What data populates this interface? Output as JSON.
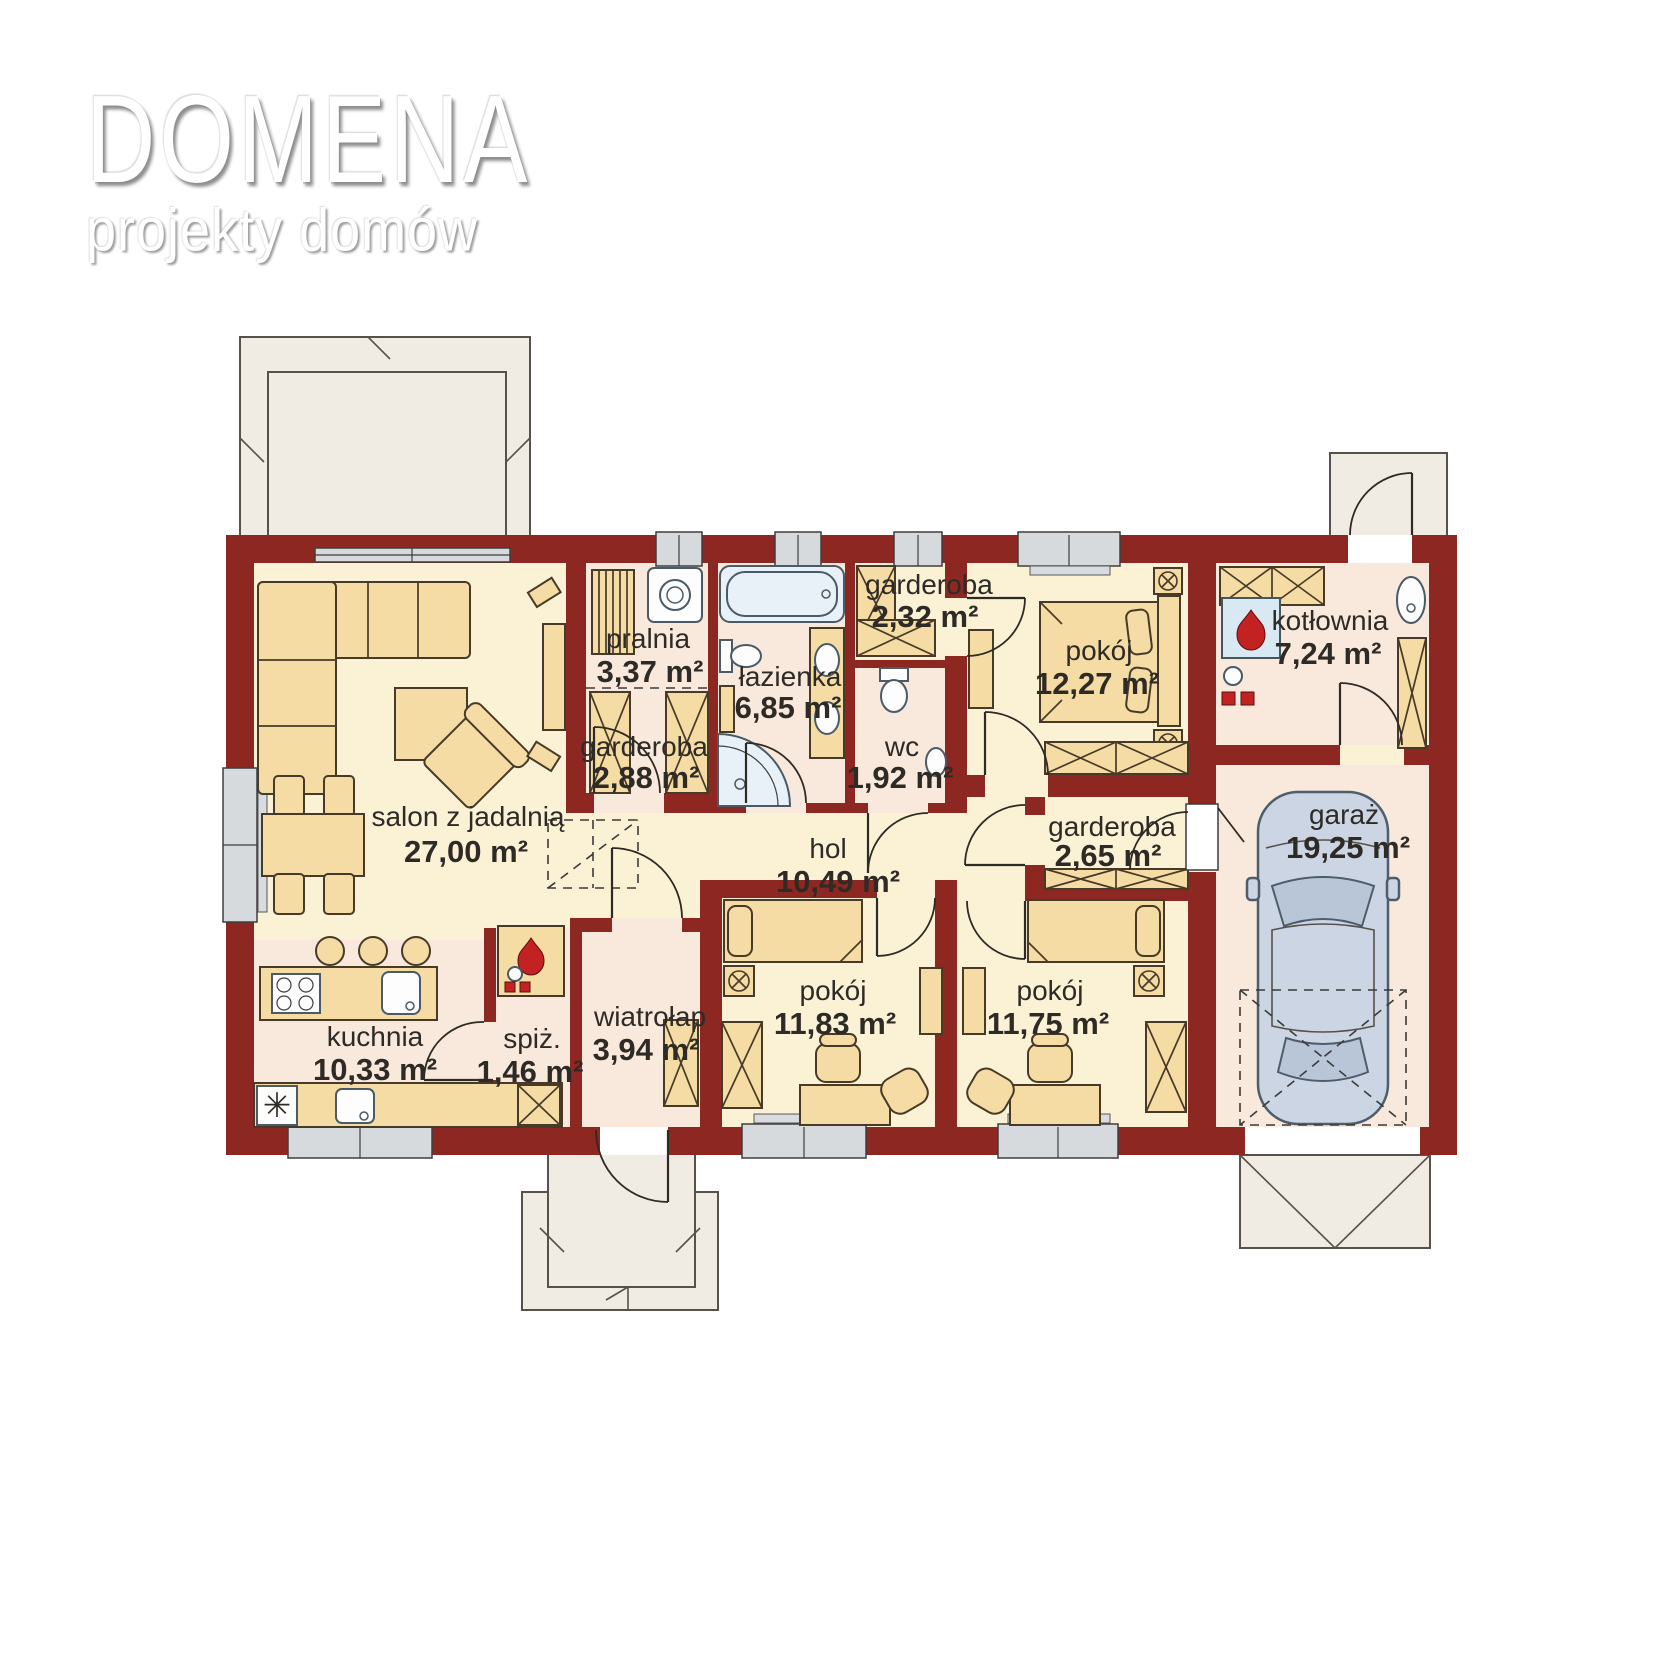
{
  "logo": {
    "title": "DOMENA",
    "subtitle": "projekty domów"
  },
  "plan": {
    "rooms": [
      {
        "id": "salon",
        "name": "salon z jadalnią",
        "area": "27,00 m²"
      },
      {
        "id": "pralnia",
        "name": "pralnia",
        "area": "3,37 m²"
      },
      {
        "id": "garderoba1",
        "name": "garderoba",
        "area": "2,88 m²"
      },
      {
        "id": "lazienka",
        "name": "łazienka",
        "area": "6,85 m²"
      },
      {
        "id": "garderoba2",
        "name": "garderoba",
        "area": "2,32 m²"
      },
      {
        "id": "wc",
        "name": "wc",
        "area": "1,92 m²"
      },
      {
        "id": "pokoj1",
        "name": "pokój",
        "area": "12,27 m²"
      },
      {
        "id": "kotlownia",
        "name": "kotłownia",
        "area": "7,24 m²"
      },
      {
        "id": "garaz",
        "name": "garaż",
        "area": "19,25 m²"
      },
      {
        "id": "garderoba3",
        "name": "garderoba",
        "area": "2,65 m²"
      },
      {
        "id": "hol",
        "name": "hol",
        "area": "10,49 m²"
      },
      {
        "id": "kuchnia",
        "name": "kuchnia",
        "area": "10,33 m²"
      },
      {
        "id": "spiz",
        "name": "spiż.",
        "area": "1,46 m²"
      },
      {
        "id": "wiatrolap",
        "name": "wiatrołap",
        "area": "3,94 m²"
      },
      {
        "id": "pokoj2",
        "name": "pokój",
        "area": "11,83 m²"
      },
      {
        "id": "pokoj3",
        "name": "pokój",
        "area": "11,75 m²"
      }
    ],
    "colors": {
      "wall": "#8C2821",
      "floor_main": "#FBF2D6",
      "floor_wet": "#F8E9DC",
      "furniture": "#F5DCA4",
      "fixture_blue": "#E8F1F8",
      "window": "#D6DADD",
      "terrace": "#F0ECE4",
      "car": "#CBD5E3",
      "flame": "#C32222"
    }
  }
}
